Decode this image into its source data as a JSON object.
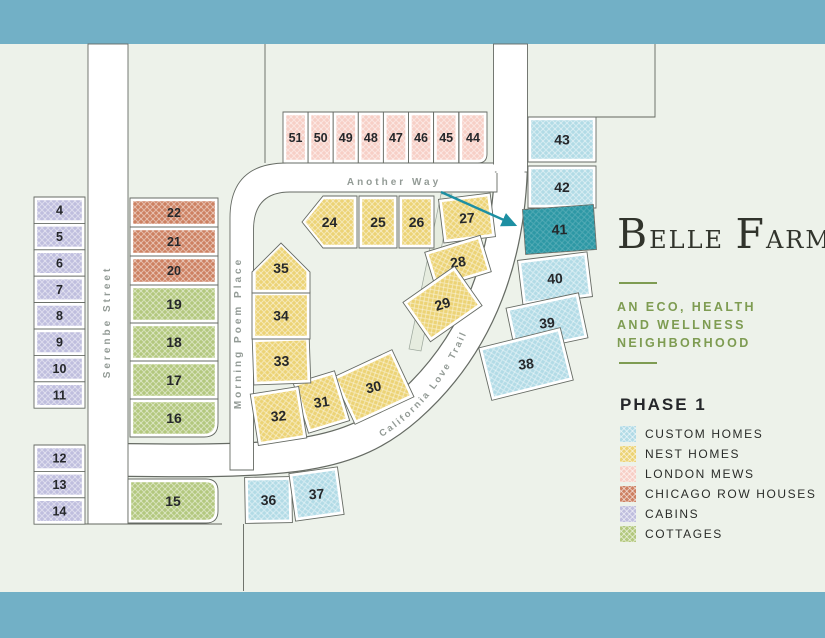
{
  "branding": {
    "title_words": [
      "Belle",
      "Farm"
    ],
    "tagline_lines": [
      "An Eco, Health",
      "and Wellness",
      "Neighborhood"
    ]
  },
  "legend": {
    "title": "Phase 1",
    "items": [
      {
        "id": "custom",
        "label": "Custom Homes",
        "color": "#b2dbe6"
      },
      {
        "id": "nest",
        "label": "Nest Homes",
        "color": "#ecd375"
      },
      {
        "id": "london",
        "label": "London Mews",
        "color": "#f7cfc6"
      },
      {
        "id": "chicago",
        "label": "Chicago Row Houses",
        "color": "#cd8162"
      },
      {
        "id": "cabins",
        "label": "Cabins",
        "color": "#bfbede"
      },
      {
        "id": "cottages",
        "label": "Cottages",
        "color": "#b3c87e"
      }
    ]
  },
  "map": {
    "streets": {
      "another_way": {
        "label": "Another Way"
      },
      "serenbe": {
        "label": "Serenbe Street"
      },
      "morning_poem": {
        "label": "Morning Poem Place"
      },
      "california_love": {
        "label": "California Love Trail"
      }
    },
    "arrow": {
      "points_to_lot": "41",
      "color": "#1d8fa2"
    },
    "featured_lot": {
      "number": "41",
      "fill": "#2d98a5",
      "text_color": "#a5d2d4"
    },
    "lots": [
      {
        "n": "4",
        "type": "cabins",
        "x": 34,
        "y": 197,
        "w": 51,
        "h": 26.4
      },
      {
        "n": "5",
        "type": "cabins",
        "x": 34,
        "y": 223.4,
        "w": 51,
        "h": 26.4
      },
      {
        "n": "6",
        "type": "cabins",
        "x": 34,
        "y": 249.8,
        "w": 51,
        "h": 26.4
      },
      {
        "n": "7",
        "type": "cabins",
        "x": 34,
        "y": 276.2,
        "w": 51,
        "h": 26.4
      },
      {
        "n": "8",
        "type": "cabins",
        "x": 34,
        "y": 302.6,
        "w": 51,
        "h": 26.4
      },
      {
        "n": "9",
        "type": "cabins",
        "x": 34,
        "y": 329,
        "w": 51,
        "h": 26.4
      },
      {
        "n": "10",
        "type": "cabins",
        "x": 34,
        "y": 355.4,
        "w": 51,
        "h": 26.4
      },
      {
        "n": "11",
        "type": "cabins",
        "x": 34,
        "y": 381.8,
        "w": 51,
        "h": 26.4
      },
      {
        "n": "12",
        "type": "cabins",
        "x": 34,
        "y": 445,
        "w": 51,
        "h": 26.4
      },
      {
        "n": "13",
        "type": "cabins",
        "x": 34,
        "y": 471.4,
        "w": 51,
        "h": 26.4
      },
      {
        "n": "14",
        "type": "cabins",
        "x": 34,
        "y": 497.8,
        "w": 51,
        "h": 26.4
      },
      {
        "n": "22",
        "type": "chicago",
        "x": 130,
        "y": 198,
        "w": 88,
        "h": 29
      },
      {
        "n": "21",
        "type": "chicago",
        "x": 130,
        "y": 227,
        "w": 88,
        "h": 29
      },
      {
        "n": "20",
        "type": "chicago",
        "x": 130,
        "y": 256,
        "w": 88,
        "h": 29
      },
      {
        "n": "19",
        "type": "cottages",
        "x": 130,
        "y": 285,
        "w": 88,
        "h": 38
      },
      {
        "n": "18",
        "type": "cottages",
        "x": 130,
        "y": 323,
        "w": 88,
        "h": 38
      },
      {
        "n": "17",
        "type": "cottages",
        "x": 130,
        "y": 361,
        "w": 88,
        "h": 38
      },
      {
        "n": "16",
        "type": "cottages",
        "x": 130,
        "y": 399,
        "w": 88,
        "h": 38,
        "rbr": 14
      },
      {
        "n": "15",
        "type": "cottages",
        "x": 128,
        "y": 479,
        "w": 90,
        "h": 44,
        "rtr": 12,
        "rbr": 12
      },
      {
        "n": "51",
        "type": "london",
        "x": 283,
        "y": 112,
        "w": 25.1,
        "h": 51
      },
      {
        "n": "50",
        "type": "london",
        "x": 308.1,
        "y": 112,
        "w": 25.1,
        "h": 51
      },
      {
        "n": "49",
        "type": "london",
        "x": 333.2,
        "y": 112,
        "w": 25.1,
        "h": 51
      },
      {
        "n": "48",
        "type": "london",
        "x": 358.3,
        "y": 112,
        "w": 25.1,
        "h": 51
      },
      {
        "n": "47",
        "type": "london",
        "x": 383.4,
        "y": 112,
        "w": 25.1,
        "h": 51
      },
      {
        "n": "46",
        "type": "london",
        "x": 408.5,
        "y": 112,
        "w": 25.1,
        "h": 51
      },
      {
        "n": "45",
        "type": "london",
        "x": 433.6,
        "y": 112,
        "w": 25.1,
        "h": 51
      },
      {
        "n": "44",
        "type": "london",
        "x": 459,
        "y": 112,
        "w": 28,
        "h": 51,
        "rbr": 9
      },
      {
        "n": "24",
        "type": "nest",
        "x": 302,
        "y": 196,
        "w": 55,
        "h": 52,
        "shape": "pent-left"
      },
      {
        "n": "25",
        "type": "nest",
        "x": 359,
        "y": 196,
        "w": 38,
        "h": 52
      },
      {
        "n": "26",
        "type": "nest",
        "x": 399,
        "y": 196,
        "w": 35,
        "h": 52
      },
      {
        "n": "27",
        "type": "nest",
        "x": 441,
        "y": 196,
        "w": 52,
        "h": 44,
        "rot": -7
      },
      {
        "n": "28",
        "type": "nest",
        "x": 429,
        "y": 243,
        "w": 58,
        "h": 38,
        "rot": -17
      },
      {
        "n": "29",
        "type": "nest",
        "x": 411,
        "y": 280,
        "w": 63,
        "h": 48,
        "rot": -35
      },
      {
        "n": "30",
        "type": "nest",
        "x": 341,
        "y": 361,
        "w": 65,
        "h": 52,
        "rot": -25
      },
      {
        "n": "31",
        "type": "nest",
        "x": 300,
        "y": 376,
        "w": 43,
        "h": 52,
        "rot": -17
      },
      {
        "n": "32",
        "type": "nest",
        "x": 254,
        "y": 390,
        "w": 49,
        "h": 52,
        "rot": -9
      },
      {
        "n": "33",
        "type": "nest",
        "x": 253,
        "y": 338,
        "w": 57,
        "h": 46,
        "rot": -2
      },
      {
        "n": "34",
        "type": "nest",
        "x": 252,
        "y": 292,
        "w": 58,
        "h": 47
      },
      {
        "n": "35",
        "type": "nest",
        "x": 252,
        "y": 243,
        "w": 58,
        "h": 50,
        "shape": "pent-up"
      },
      {
        "n": "43",
        "type": "custom",
        "x": 528,
        "y": 117,
        "w": 68,
        "h": 45
      },
      {
        "n": "42",
        "type": "custom",
        "x": 528,
        "y": 166,
        "w": 68,
        "h": 42
      },
      {
        "n": "41",
        "type": "custom",
        "x": 524,
        "y": 207,
        "w": 71,
        "h": 45,
        "rot": -4,
        "featured": true
      },
      {
        "n": "40",
        "type": "custom",
        "x": 520,
        "y": 256,
        "w": 70,
        "h": 45,
        "rot": -7
      },
      {
        "n": "39",
        "type": "custom",
        "x": 510,
        "y": 300,
        "w": 74,
        "h": 46,
        "rot": -12
      },
      {
        "n": "38",
        "type": "custom",
        "x": 484,
        "y": 337,
        "w": 84,
        "h": 54,
        "rot": -14
      },
      {
        "n": "36",
        "type": "custom",
        "x": 245,
        "y": 477,
        "w": 47,
        "h": 46,
        "rot": -1
      },
      {
        "n": "37",
        "type": "custom",
        "x": 292,
        "y": 470,
        "w": 49,
        "h": 48,
        "rot": -8
      }
    ]
  },
  "colors": {
    "band": "#72b0c6",
    "background": "#edf2ea",
    "road": "#ffffff",
    "outline": "#666b64",
    "lot_number": "#25272a",
    "street_label": "#939b96",
    "logo": "#31342c",
    "olive": "#7e9c52",
    "legend_text": "#2a2c29",
    "arrow": "#1d8fa2",
    "featured_fill": "#2d98a5",
    "featured_text": "#a5d2d4"
  }
}
